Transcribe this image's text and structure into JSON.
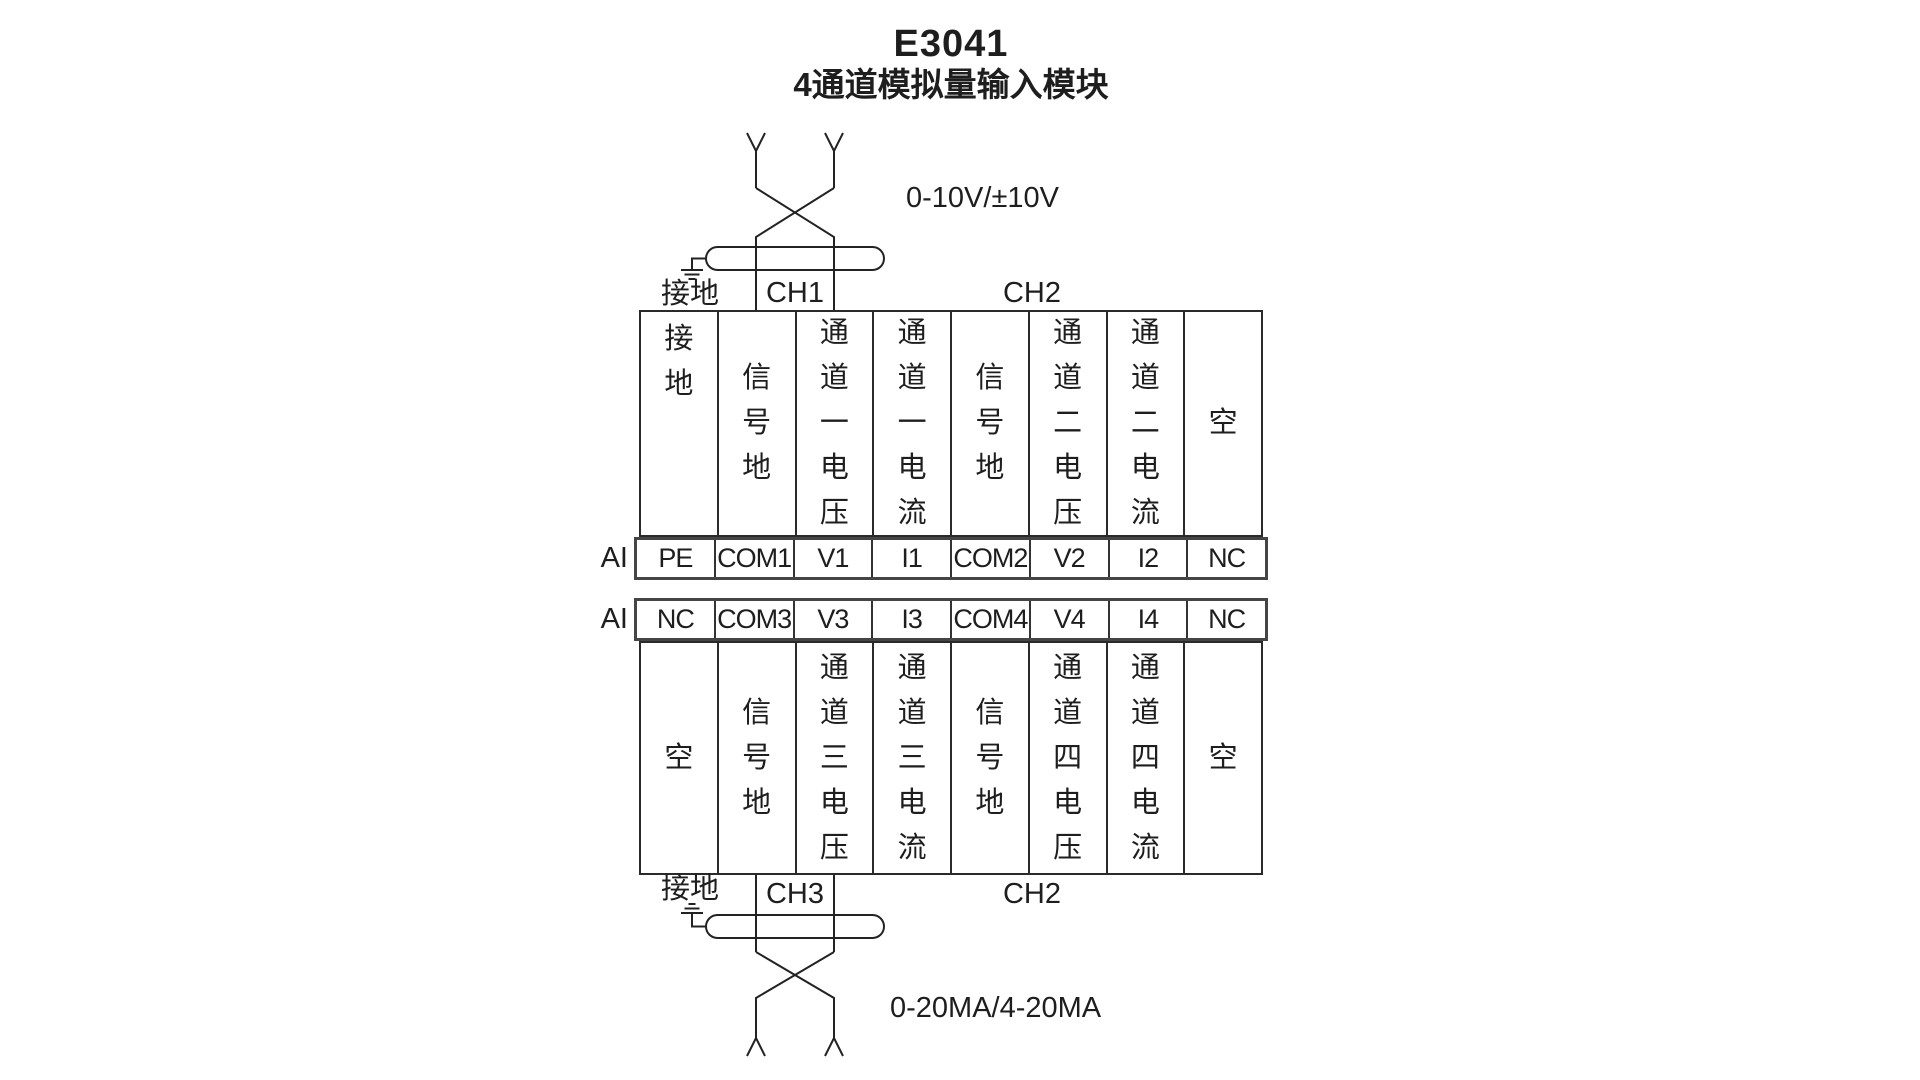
{
  "title": {
    "model": "E3041",
    "name": "4通道模拟量输入模块"
  },
  "top_wiring": {
    "signal_range_label": "0-10V/±10V",
    "ground_label": "接地",
    "channel_left_label": "CH1",
    "channel_right_label": "CH2"
  },
  "bottom_wiring": {
    "signal_range_label": "0-20MA/4-20MA",
    "ground_label": "接地",
    "channel_left_label": "CH3",
    "channel_right_label": "CH2"
  },
  "terminal_table_top": {
    "row_label": "AI",
    "function_columns": [
      "接地",
      "信号地",
      "通道一电压",
      "通道一电流",
      "信号地",
      "通道二电压",
      "通道二电流",
      "空"
    ],
    "terminals": [
      "PE",
      "COM1",
      "V1",
      "I1",
      "COM2",
      "V2",
      "I2",
      "NC"
    ]
  },
  "terminal_table_bottom": {
    "row_label": "AI",
    "terminals": [
      "NC",
      "COM3",
      "V3",
      "I3",
      "COM4",
      "V4",
      "I4",
      "NC"
    ],
    "function_columns": [
      "空",
      "信号地",
      "通道三电压",
      "通道三电流",
      "信号地",
      "通道四电压",
      "通道四电流",
      "空"
    ]
  },
  "colors": {
    "line": "#2a2a2a",
    "text": "#1e1e1e"
  }
}
